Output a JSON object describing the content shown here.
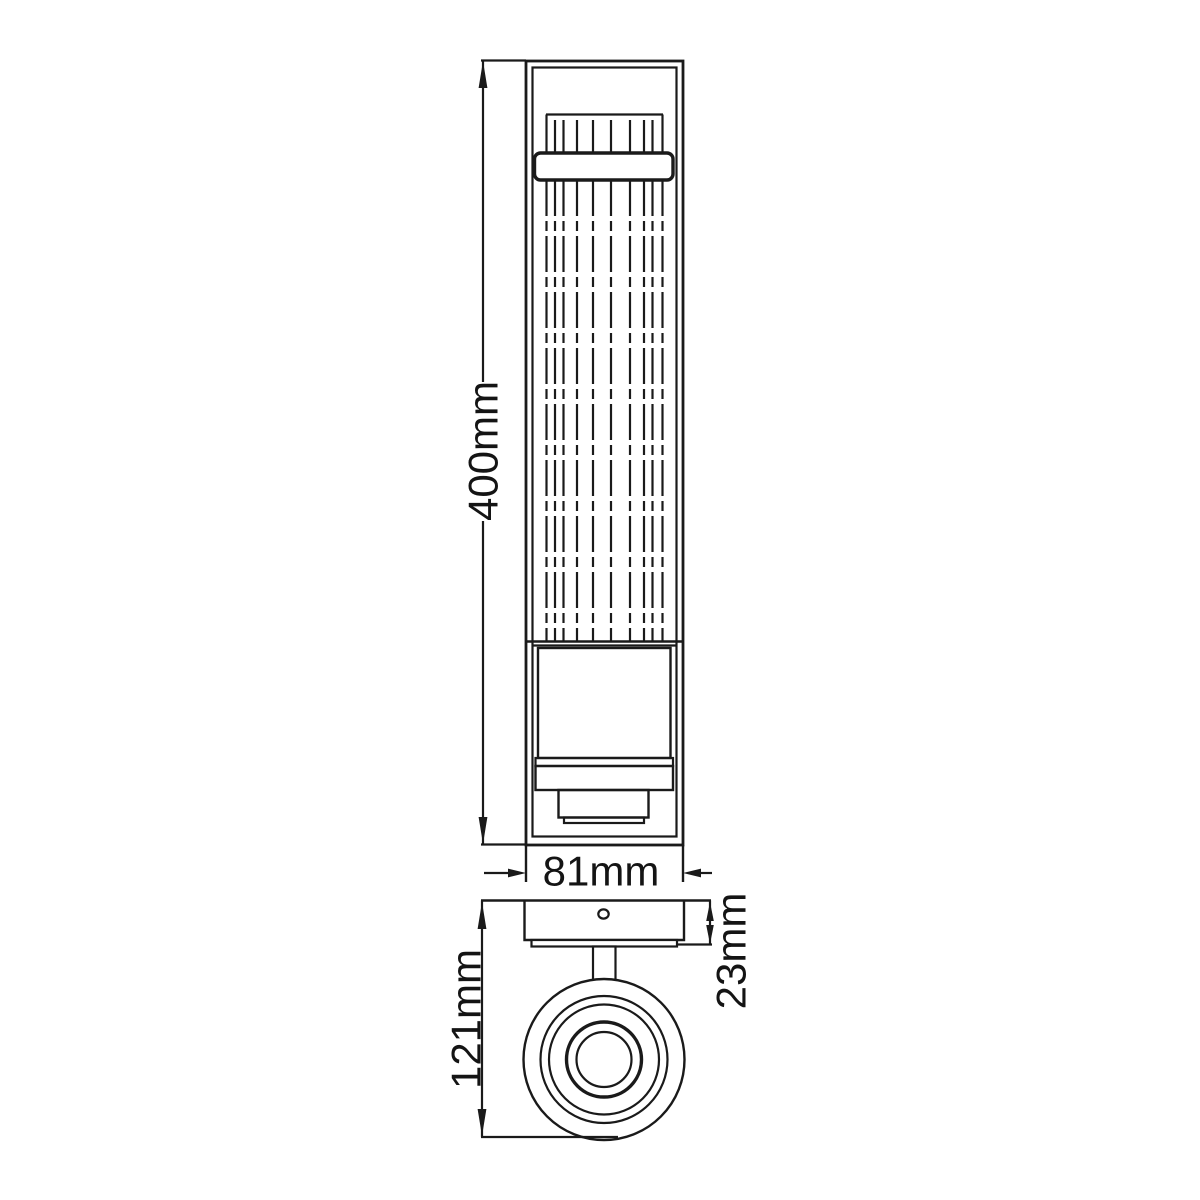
{
  "canvas": {
    "background": "#ffffff",
    "line_color": "#1a1a1a",
    "text_color": "#141414"
  },
  "dimensions": {
    "overall_height": {
      "label": "400mm",
      "orientation": "vertical"
    },
    "overall_width": {
      "label": "81mm",
      "orientation": "horizontal"
    },
    "projection_depth": {
      "label": "121mm",
      "orientation": "vertical"
    },
    "backplate_thickness": {
      "label": "23mm",
      "orientation": "vertical"
    }
  }
}
